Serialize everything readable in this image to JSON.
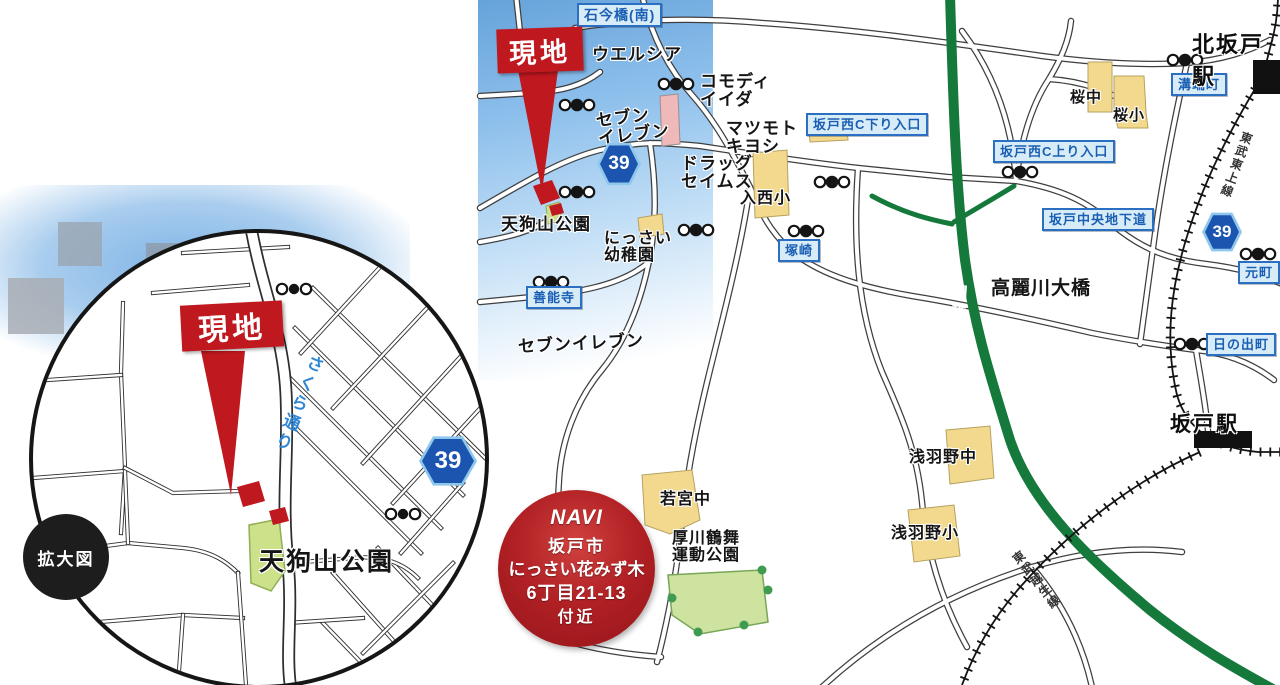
{
  "colors": {
    "expressway_green": "#16793c",
    "site_red": "#c0181f",
    "sign_blue": "#1a5fb4",
    "route_shield_blue": "#1b55b0",
    "school_tan": "#f3d98e",
    "park_green": "#cfe3a0"
  },
  "inset": {
    "site_label": "現地",
    "street": "さくら通り",
    "park": "天狗山公園",
    "caption": "拡大図",
    "route_number": "39"
  },
  "map": {
    "route_number": "39",
    "site_label": "現地",
    "signs": {
      "ishiima_bridge": "石今橋(南)",
      "sakadonishi_down": "坂戸西C下り入口",
      "sakadonishi_up": "坂戸西C上り入口",
      "sakado_underpass": "坂戸中央地下道",
      "mizobata": "溝端町",
      "motomachi": "元町",
      "hinodecho": "日の出町",
      "zennoji": "善能寺",
      "tsukazaki": "塚崎"
    },
    "pois": {
      "welcia": "ウエルシア",
      "commodi_iida": "コモディ\nイイダ",
      "seven_eleven_north": "セブン\nイレブン",
      "matsumoto_kiyoshi": "マツモト\nキヨシ",
      "drug_seimus": "ドラッグ\nセイムス",
      "nissai_elementary": "入西小",
      "nissai_kindergarten": "にっさい\n幼稚園",
      "tenguyama_park": "天狗山公園",
      "seven_eleven_south": "セブンイレブン",
      "komagawa_bridge": "高麗川大橋",
      "sakura_jhs": "桜中",
      "sakura_es": "桜小",
      "wakamiya_jhs": "若宮中",
      "asabano_jhs": "浅羽野中",
      "asabano_es": "浅羽野小",
      "atsukawa_park": "厚川鶴舞\n運動公園"
    },
    "stations": {
      "kita_sakado": "北坂戸駅",
      "sakado": "坂戸駅"
    },
    "railways": {
      "tojo": "東武東上線",
      "ogose": "東武越生線"
    },
    "expressway": "関越道",
    "navi": {
      "badge": "NAVI",
      "line1": "坂戸市",
      "line2": "にっさい花みず木",
      "line3": "6丁目21-13",
      "line4": "付近"
    }
  }
}
